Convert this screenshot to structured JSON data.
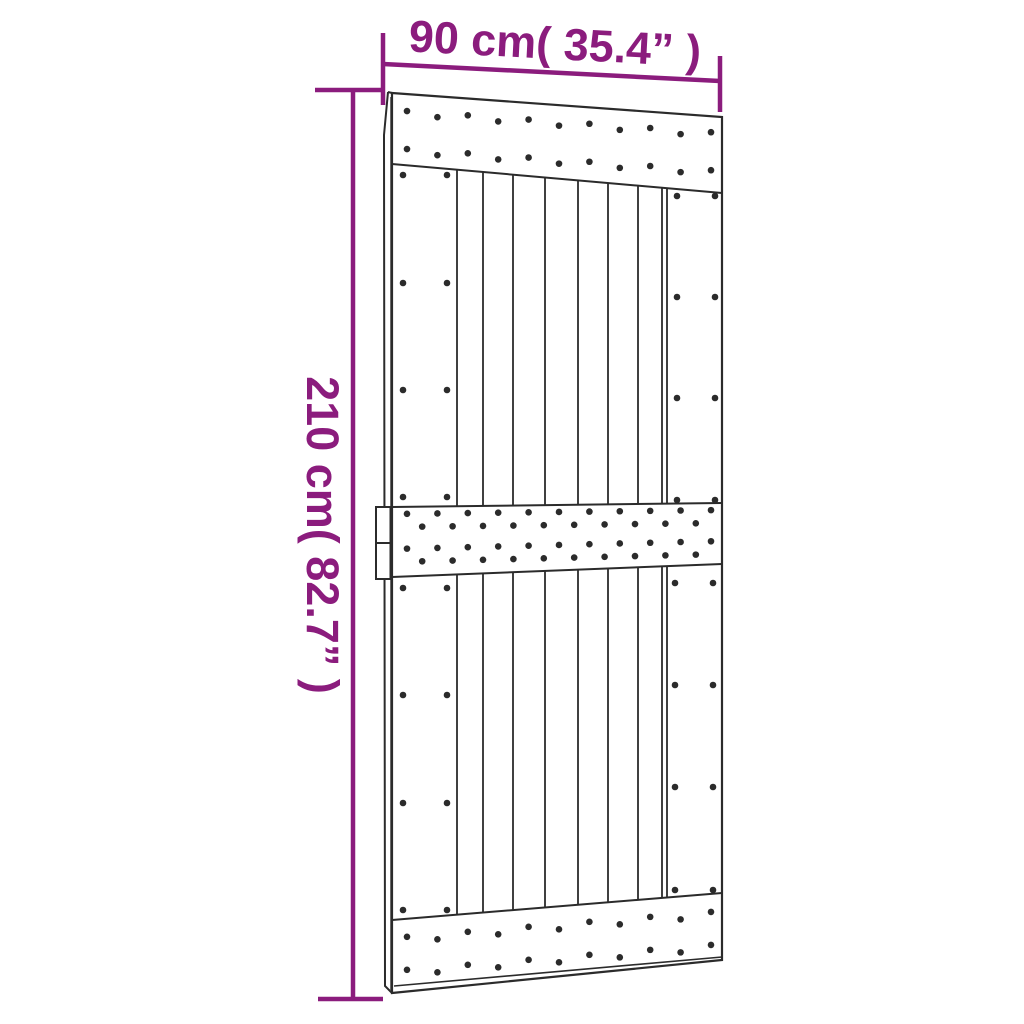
{
  "labels": {
    "width": "90 cm( 35.4” )",
    "height": "210 cm( 82.7” )"
  },
  "measurements": {
    "width_cm": 90,
    "width_inches": 35.4,
    "height_cm": 210,
    "height_inches": 82.7
  },
  "colors": {
    "background": "#ffffff",
    "line": "#2b2b2b",
    "accent": "#8b1c7d"
  }
}
